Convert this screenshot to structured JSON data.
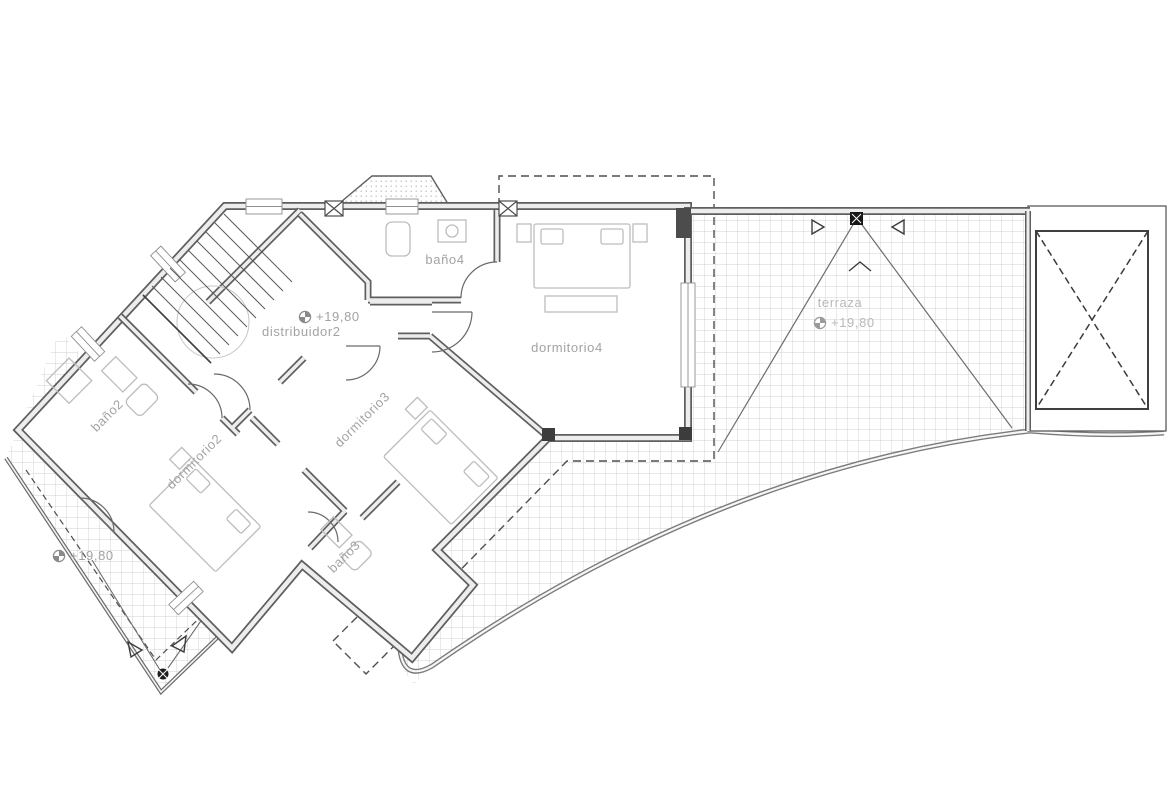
{
  "document": {
    "type": "architectural floor plan",
    "plan_title": "planta segunda / second floor plan"
  },
  "labels": {
    "bano4": "baño4",
    "distribuidor2": "distribuidor2",
    "dormitorio4": "dormitorio4",
    "terraza": "terraza",
    "bano2": "baño2",
    "dormitorio2": "dormitorio2",
    "dormitorio3": "dormitorio3",
    "bano3": "baño3"
  },
  "levels": {
    "distribuidor2": "+19,80",
    "terraza": "+19,80",
    "terraza_lower": "+19,80"
  },
  "symbols": {
    "level_marker": "benchmark-level-icon",
    "drain": "drain-point-icon",
    "slope_arrow": "slope-arrow-icon",
    "void_cross": "dashed-x-void"
  },
  "colors": {
    "background": "#ffffff",
    "wall": "#5f5f5f",
    "wall_fill": "#ededed",
    "hatch": "#cdd1d5",
    "furniture": "#bdbdbd",
    "label": "#a3a3a3",
    "label_light": "#b9b9b9",
    "dashed": "#4f4f4f"
  }
}
